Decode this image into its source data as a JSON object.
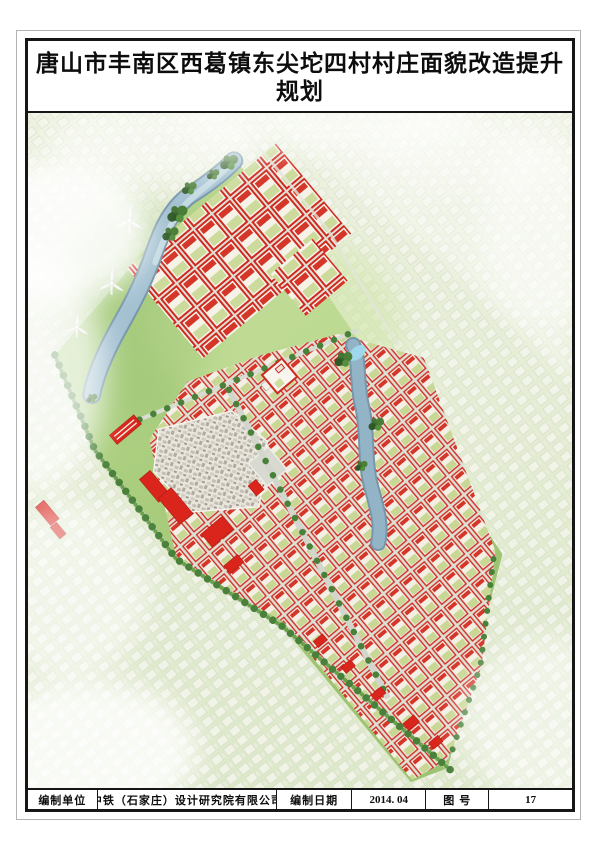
{
  "header": {
    "title": "唐山市丰南区西葛镇东尖坨四村村庄面貌改造提升规划",
    "subtitle": "——村庄规划效果图"
  },
  "footer": {
    "cells": [
      {
        "text": "编制单位",
        "role": "label"
      },
      {
        "text": "中铁（石家庄）设计研究院有限公司",
        "role": "value"
      },
      {
        "text": "编制日期",
        "role": "label"
      },
      {
        "text": "2014. 04",
        "role": "value"
      },
      {
        "text": "图 号",
        "role": "label"
      },
      {
        "text": "17",
        "role": "value"
      }
    ]
  },
  "rendering": {
    "kind": "village-master-plan-birdseye",
    "colors": {
      "building_red": "#d9251c",
      "house_wall_red": "#cf2a20",
      "house_fill": "#f4efe5",
      "courtyard_green": "#cbd999",
      "field_green": "#a8cc7c",
      "faded_village": "#eff2e5",
      "water_blue": "#a3c0d1",
      "water_edge": "#7796aa",
      "road_gray": "#c8ccc1",
      "tree_green": "#3f7234",
      "street_tree_green": "#49813a",
      "fog_white": "#ffffff"
    }
  }
}
